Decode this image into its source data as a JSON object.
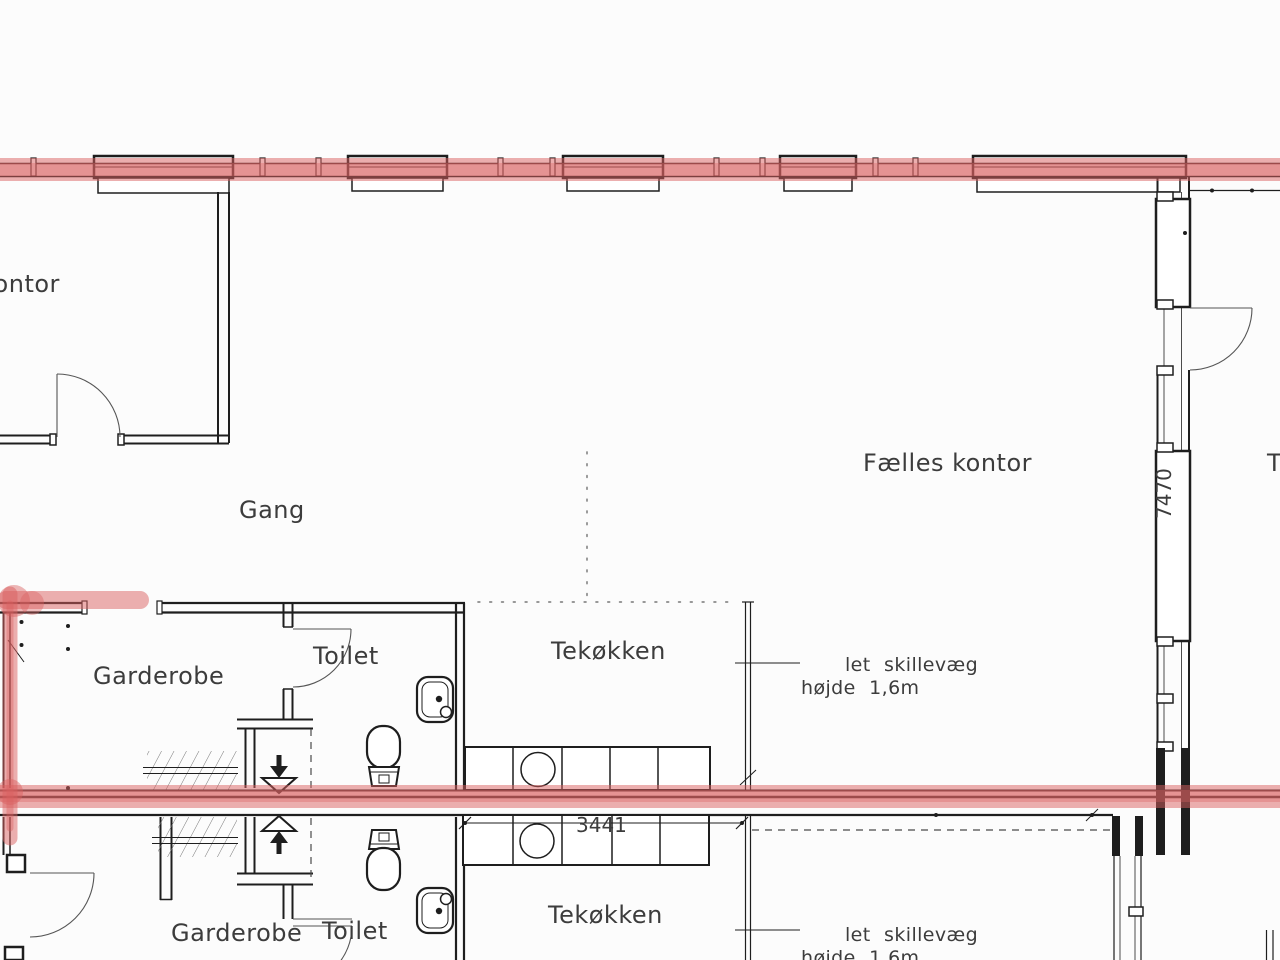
{
  "labels": {
    "kontor": "kontor",
    "gang": "Gang",
    "faelles_kontor": "Fælles kontor",
    "garderobe_top": "Garderobe",
    "toilet_top": "Toilet",
    "tekokken_top": "Tekøkken",
    "garderobe_bottom": "Garderobe",
    "toilet_bottom": "Toilet",
    "tekokken_bottom": "Tekøkken",
    "adjacent_room_clipped": "T"
  },
  "annotations": {
    "partition_top_line1": "let skillevæg",
    "partition_top_line2": "højde 1,6m",
    "partition_bottom_line1": "let skillevæg",
    "partition_bottom_line2": "højde 1,6m"
  },
  "dimensions": {
    "counter_width": "3441",
    "glazed_wall_height": "7470"
  },
  "colors": {
    "highlight_red": "#d96060",
    "line_black": "#1e1e1e",
    "text_gray": "#3c3c3c",
    "background": "#fcfcfc"
  }
}
